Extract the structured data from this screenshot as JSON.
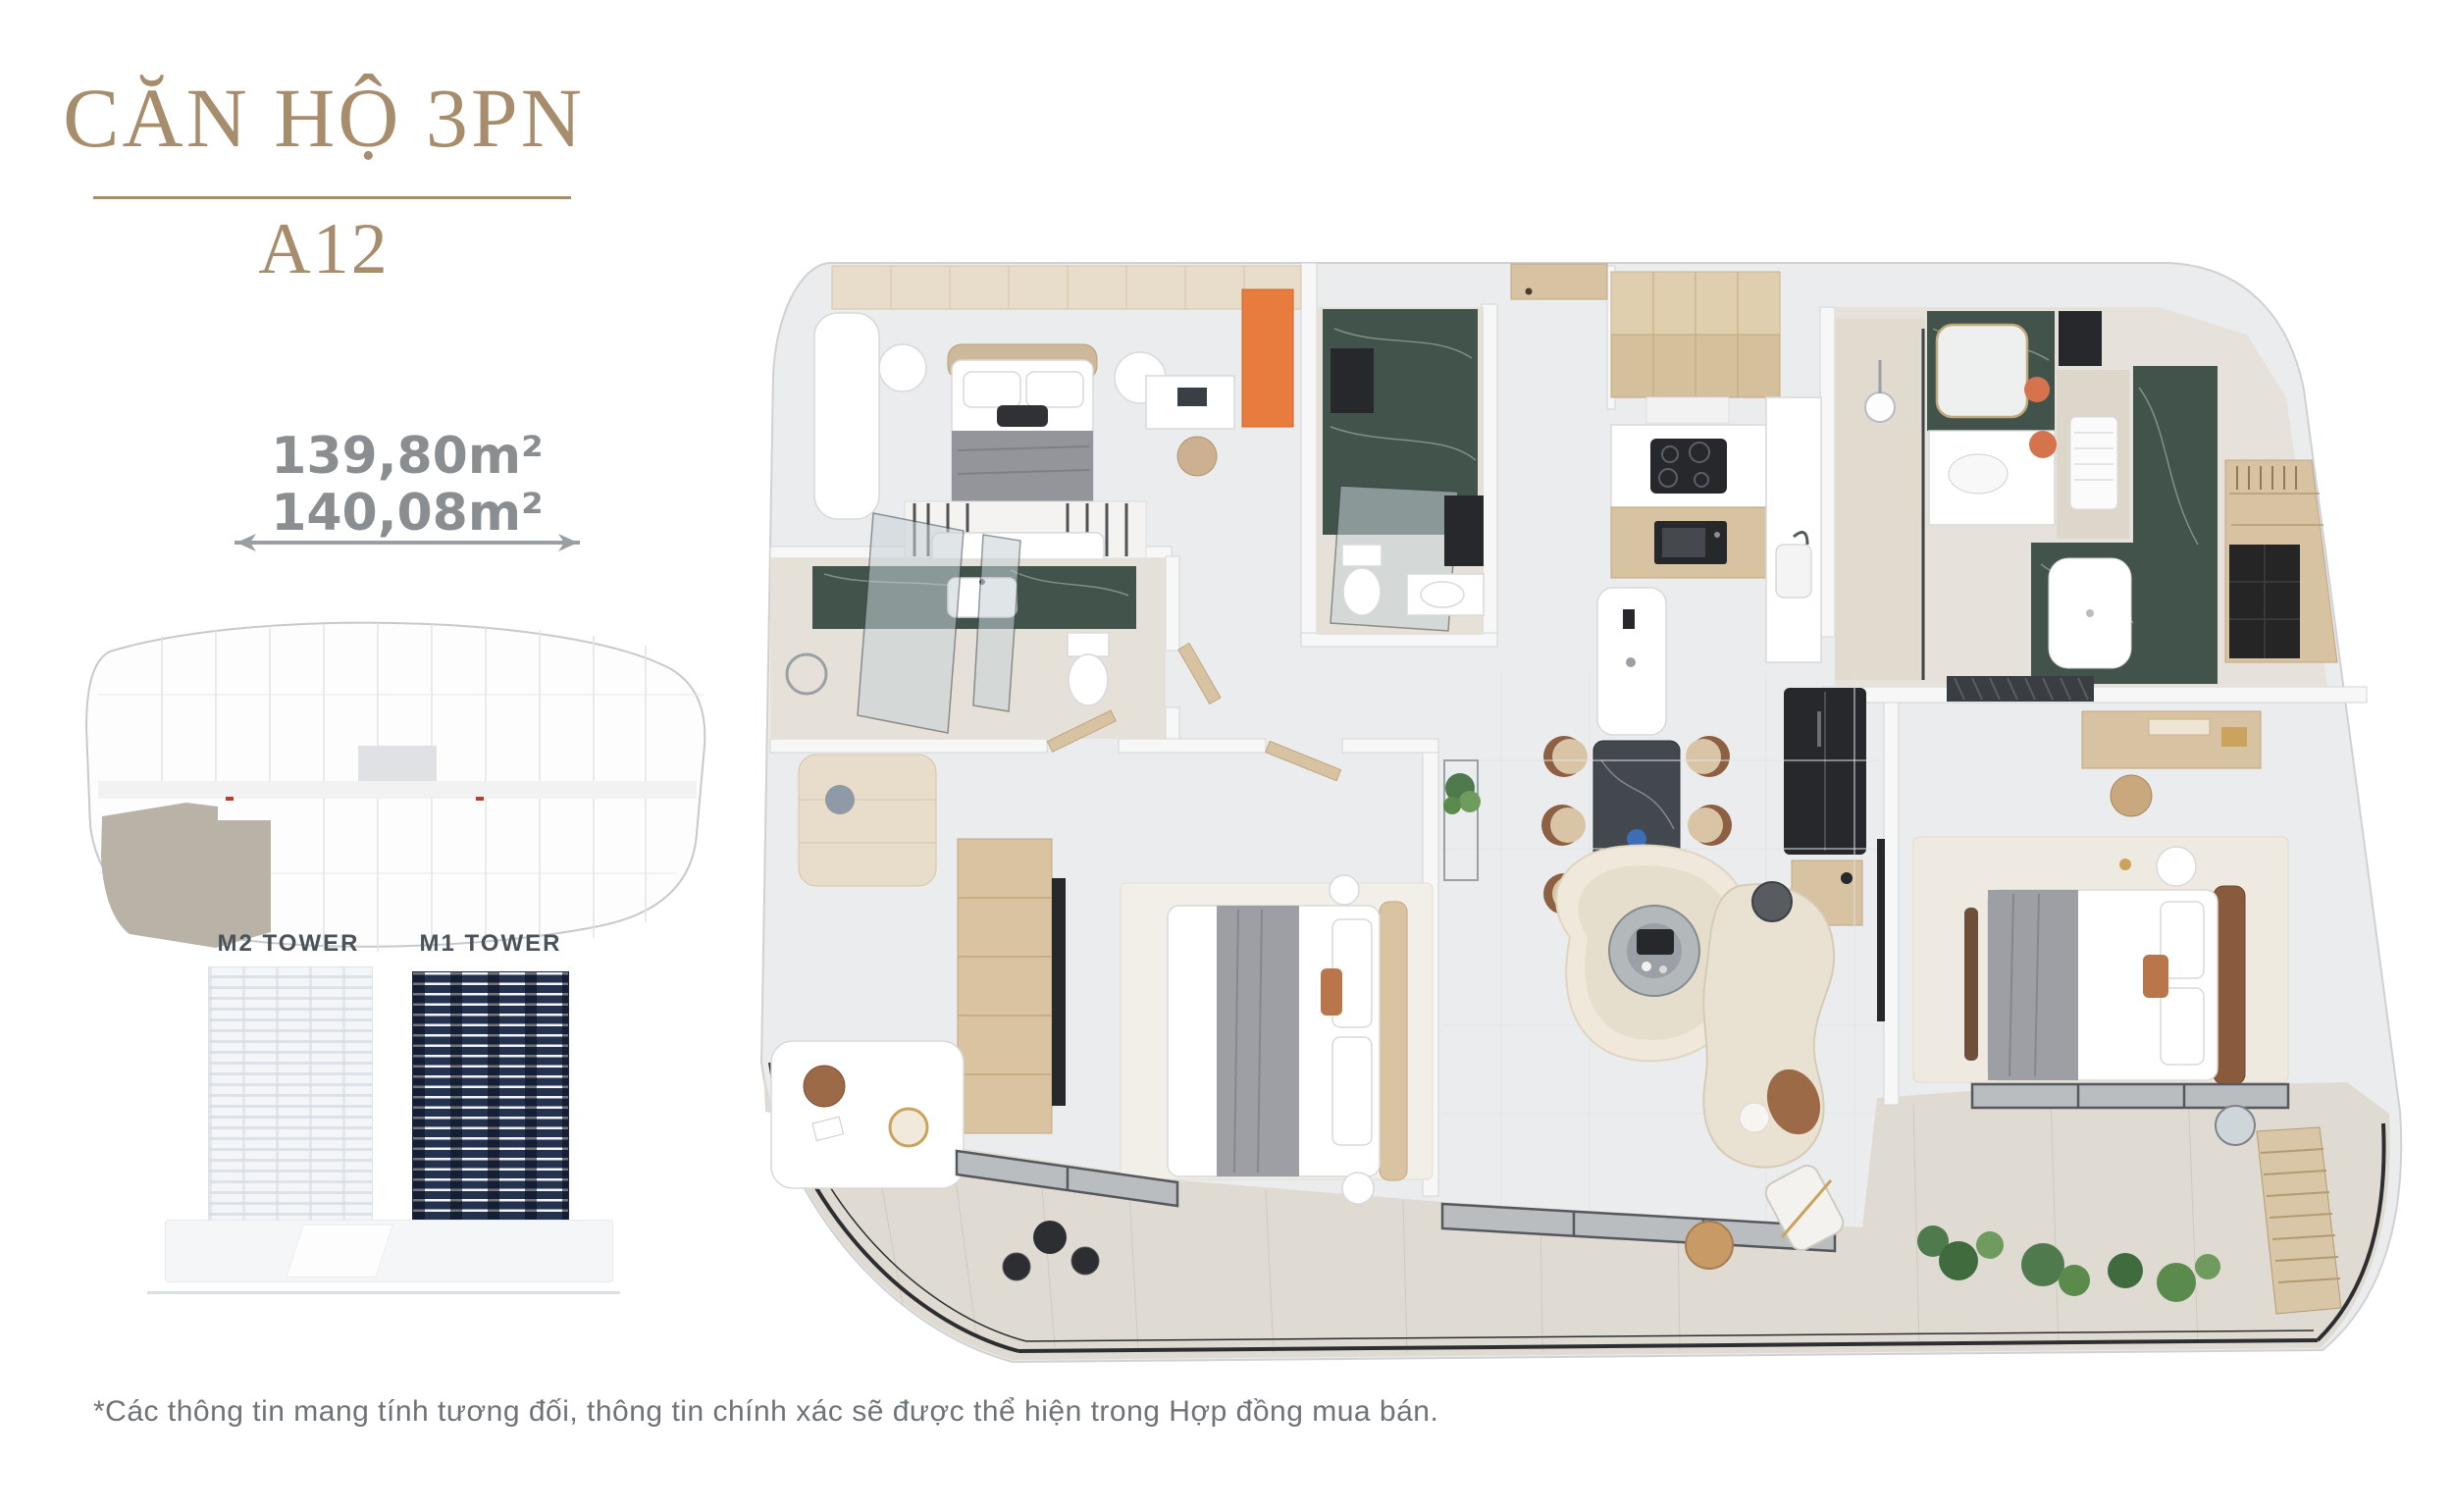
{
  "header": {
    "title": "CĂN HỘ 3PN",
    "unit": "A12"
  },
  "area": {
    "line1": "139,80m²",
    "line2": "140,08m²"
  },
  "towers": {
    "left_label": "M2 TOWER",
    "right_label": "M1 TOWER",
    "highlighted": "M1 TOWER"
  },
  "footnote": "*Các thông tin mang tính tương đối, thông tin chính xác sẽ được thể hiện trong Hợp đồng mua bán.",
  "colors": {
    "accent_gold": "#A78D6C",
    "area_text_gray": "#8A8E90",
    "tower_label_gray": "#4C525A",
    "footnote_gray": "#6F7378",
    "m1_tower_navy": "#24324F",
    "m2_tower_light": "#F3F5F8",
    "unit_highlight_taupe": "#B9B2A7",
    "marble_green": "#41534B",
    "accent_orange": "#E87C3E",
    "wood_tan": "#D7C2A1",
    "floor_gray": "#EBECEE",
    "balcony_rail_black": "#2C2E31"
  },
  "icons": {
    "dimension_arrow": "double-headed-arrow"
  }
}
